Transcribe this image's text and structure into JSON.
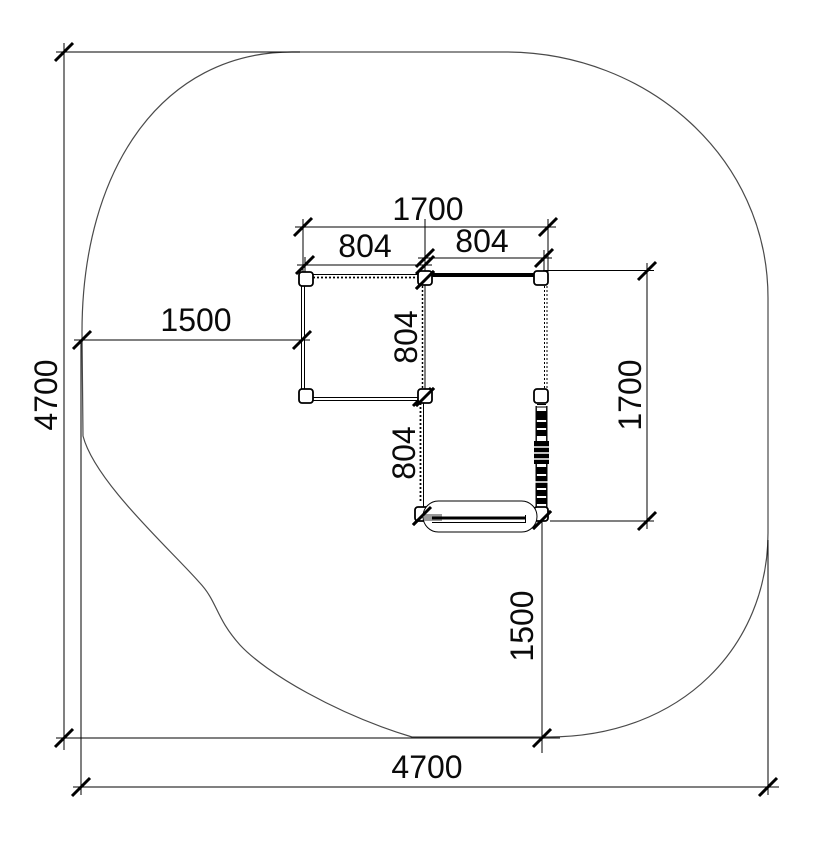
{
  "drawing": {
    "type": "playground-equipment-plan-with-safety-zone",
    "background": "#ffffff",
    "colors": {
      "dimension_lines": "#000000",
      "zone_outline": "#4a4a4a",
      "bench_accent": "#9a9a9a"
    },
    "dims": {
      "overall_height": "4700",
      "overall_width": "4700",
      "zone_offset_left": "1500",
      "zone_offset_bottom": "1500",
      "structure_width_total": "1700",
      "structure_height_total": "1700",
      "bay_top_left": "804",
      "bay_top_right": "804",
      "bay_mid_vertical": "804",
      "bay_lower_vertical": "804"
    }
  }
}
